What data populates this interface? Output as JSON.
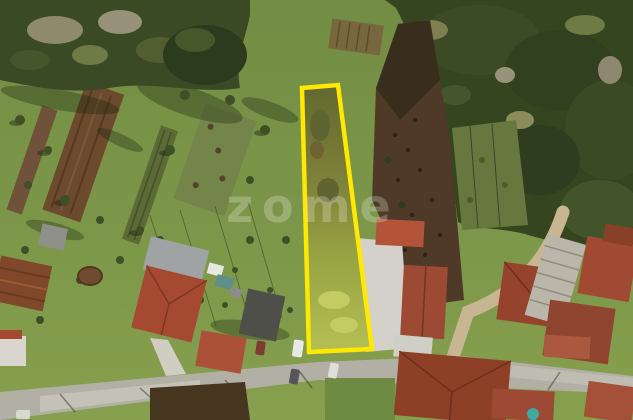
{
  "scene": {
    "type": "aerial-drone-photo",
    "subject": "rural-land-plot-highlighted-for-sale",
    "watermark": {
      "text": "zome",
      "color": "#ffffff",
      "opacity": "0.24",
      "font_size": "46"
    },
    "plot_outline": {
      "points": "302,88 338,85 372,349 309,352",
      "color": "#ffe802",
      "stroke_width": "4.5"
    },
    "palette": {
      "field_green": "#7d9a4e",
      "forest_green": "#3a4a25",
      "plot_grass_bright": "#b4bf55",
      "plot_grass_shadow": "#63682f",
      "plowed_brown": "#4e3a26",
      "asphalt_road": "#b2afa5",
      "dirt_road": "#c7b691",
      "driveway_white": "#d3d1c9",
      "roof_red": "#9c4a33",
      "roof_rusty": "#80482a",
      "roof_gray": "#4f4f49"
    }
  }
}
